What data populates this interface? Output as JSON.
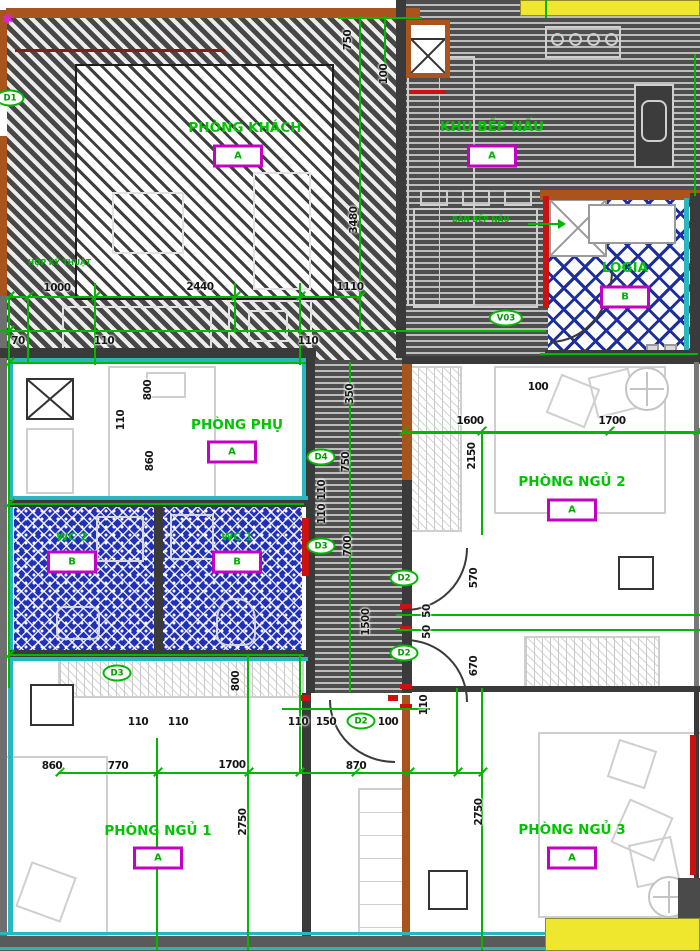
{
  "plan": {
    "type": "apartment-floor-plan",
    "colors": {
      "dimension_green": "#00b800",
      "label_green": "#00c400",
      "badge_magenta": "#c400c4",
      "wall_orange": "#a8541c",
      "accent_cyan": "#29b6bf",
      "lattice_navy": "#1d2f9e",
      "wc_blue": "#2030b8",
      "door_red": "#cc1111",
      "corner_yellow": "#efe62e",
      "hatch_dark": "#4a4a4a"
    },
    "rooms": [
      {
        "name": "PHÒNG KHÁCH",
        "tag": "A",
        "lx": 245,
        "ly": 128,
        "bx": 238,
        "by": 156
      },
      {
        "name": "KHU BẾP NẤU",
        "tag": "A",
        "lx": 492,
        "ly": 127,
        "bx": 492,
        "by": 156
      },
      {
        "name": "LOGIA",
        "tag": "B",
        "lx": 625,
        "ly": 268,
        "bx": 625,
        "by": 297
      },
      {
        "name": "PHÒNG PHỤ",
        "tag": "A",
        "lx": 237,
        "ly": 425,
        "bx": 232,
        "by": 452
      },
      {
        "name": "WC 2",
        "tag": "B",
        "sm": 1,
        "lx": 72,
        "ly": 537,
        "bx": 72,
        "by": 562
      },
      {
        "name": "WC 1",
        "tag": "B",
        "sm": 1,
        "lx": 237,
        "ly": 537,
        "bx": 237,
        "by": 562
      },
      {
        "name": "PHÒNG NGỦ 2",
        "tag": "A",
        "lx": 572,
        "ly": 482,
        "bx": 572,
        "by": 510
      },
      {
        "name": "PHÒNG NGỦ 1",
        "tag": "A",
        "lx": 158,
        "ly": 831,
        "bx": 158,
        "by": 858
      },
      {
        "name": "PHÒNG NGỦ 3",
        "tag": "A",
        "lx": 572,
        "ly": 830,
        "bx": 572,
        "by": 858
      }
    ],
    "tags": [
      {
        "t": "D1",
        "x": 10,
        "y": 98
      },
      {
        "t": "V03",
        "x": 506,
        "y": 318
      },
      {
        "t": "D4",
        "x": 321,
        "y": 457
      },
      {
        "t": "D3",
        "x": 321,
        "y": 546
      },
      {
        "t": "D2",
        "x": 404,
        "y": 578
      },
      {
        "t": "D2",
        "x": 404,
        "y": 653
      },
      {
        "t": "D3",
        "x": 117,
        "y": 673
      },
      {
        "t": "D2",
        "x": 361,
        "y": 721
      }
    ],
    "dims": [
      {
        "t": "1000",
        "x": 57,
        "y": 288
      },
      {
        "t": "2440",
        "x": 200,
        "y": 287
      },
      {
        "t": "1110",
        "x": 350,
        "y": 287
      },
      {
        "t": "70",
        "x": 18,
        "y": 341
      },
      {
        "t": "110",
        "x": 104,
        "y": 341
      },
      {
        "t": "110",
        "x": 308,
        "y": 341
      },
      {
        "t": "750",
        "x": 348,
        "y": 40,
        "v": 1
      },
      {
        "t": "100",
        "x": 384,
        "y": 74,
        "v": 1
      },
      {
        "t": "3480",
        "x": 354,
        "y": 220,
        "v": 1
      },
      {
        "t": "800",
        "x": 148,
        "y": 390,
        "v": 1
      },
      {
        "t": "110",
        "x": 121,
        "y": 420,
        "v": 1
      },
      {
        "t": "860",
        "x": 150,
        "y": 461,
        "v": 1
      },
      {
        "t": "100",
        "x": 538,
        "y": 387
      },
      {
        "t": "1600",
        "x": 470,
        "y": 421
      },
      {
        "t": "1700",
        "x": 612,
        "y": 421
      },
      {
        "t": "2150",
        "x": 472,
        "y": 456,
        "v": 1
      },
      {
        "t": "350",
        "x": 350,
        "y": 394,
        "v": 1
      },
      {
        "t": "750",
        "x": 346,
        "y": 462,
        "v": 1
      },
      {
        "t": "110",
        "x": 322,
        "y": 490,
        "v": 1
      },
      {
        "t": "110",
        "x": 322,
        "y": 514,
        "v": 1
      },
      {
        "t": "700",
        "x": 348,
        "y": 546,
        "v": 1
      },
      {
        "t": "1500",
        "x": 366,
        "y": 622,
        "v": 1
      },
      {
        "t": "570",
        "x": 474,
        "y": 578,
        "v": 1
      },
      {
        "t": "50",
        "x": 427,
        "y": 611,
        "v": 1
      },
      {
        "t": "50",
        "x": 427,
        "y": 632,
        "v": 1
      },
      {
        "t": "670",
        "x": 474,
        "y": 666,
        "v": 1
      },
      {
        "t": "110",
        "x": 424,
        "y": 705,
        "v": 1
      },
      {
        "t": "800",
        "x": 236,
        "y": 681,
        "v": 1
      },
      {
        "t": "110",
        "x": 138,
        "y": 722
      },
      {
        "t": "110",
        "x": 178,
        "y": 722
      },
      {
        "t": "110",
        "x": 298,
        "y": 722
      },
      {
        "t": "150",
        "x": 326,
        "y": 722
      },
      {
        "t": "100",
        "x": 388,
        "y": 722
      },
      {
        "t": "860",
        "x": 52,
        "y": 766
      },
      {
        "t": "770",
        "x": 118,
        "y": 766
      },
      {
        "t": "1700",
        "x": 232,
        "y": 765
      },
      {
        "t": "870",
        "x": 356,
        "y": 766
      },
      {
        "t": "2750",
        "x": 243,
        "y": 822,
        "v": 1
      },
      {
        "t": "2750",
        "x": 479,
        "y": 812,
        "v": 1
      }
    ],
    "lines": [
      [
        8,
        296,
        352,
        2
      ],
      [
        0,
        330,
        546,
        2
      ],
      [
        540,
        353,
        158,
        2
      ],
      [
        8,
        362,
        298,
        2
      ],
      [
        402,
        431,
        298,
        3
      ],
      [
        8,
        503,
        296,
        2
      ],
      [
        8,
        654,
        296,
        2
      ],
      [
        396,
        614,
        304,
        2
      ],
      [
        396,
        629,
        304,
        2
      ],
      [
        282,
        708,
        148,
        2
      ],
      [
        58,
        772,
        424,
        2
      ],
      [
        338,
        17,
        84,
        2
      ],
      [
        8,
        296,
        2,
        392
      ],
      [
        27,
        296,
        2,
        68
      ],
      [
        94,
        283,
        2,
        82
      ],
      [
        234,
        283,
        2,
        50
      ],
      [
        299,
        283,
        2,
        82
      ],
      [
        299,
        654,
        2,
        120
      ],
      [
        359,
        16,
        2,
        316
      ],
      [
        384,
        16,
        2,
        62
      ],
      [
        349,
        362,
        2,
        330
      ],
      [
        481,
        431,
        2,
        104
      ],
      [
        545,
        0,
        2,
        18
      ],
      [
        694,
        54,
        2,
        142
      ],
      [
        247,
        656,
        2,
        294
      ],
      [
        156,
        738,
        2,
        212
      ],
      [
        456,
        688,
        2,
        86
      ],
      [
        481,
        688,
        2,
        262
      ]
    ],
    "ticks": [
      [
        4,
        295
      ],
      [
        23,
        295
      ],
      [
        90,
        295
      ],
      [
        230,
        295
      ],
      [
        295,
        295
      ],
      [
        355,
        295
      ],
      [
        4,
        329
      ],
      [
        4,
        361
      ],
      [
        4,
        502
      ],
      [
        4,
        653
      ],
      [
        54,
        771
      ],
      [
        152,
        771
      ],
      [
        243,
        771
      ],
      [
        294,
        771
      ],
      [
        350,
        771
      ],
      [
        404,
        771
      ],
      [
        452,
        771
      ],
      [
        477,
        771
      ],
      [
        398,
        430
      ],
      [
        476,
        430
      ],
      [
        604,
        430
      ],
      [
        692,
        430
      ]
    ],
    "annotations": [
      {
        "t": "HỘP KỸ THUẬT",
        "x": 28,
        "y": 258
      },
      {
        "t": "BÀN BẾP NẤU",
        "x": 452,
        "y": 215
      }
    ]
  }
}
